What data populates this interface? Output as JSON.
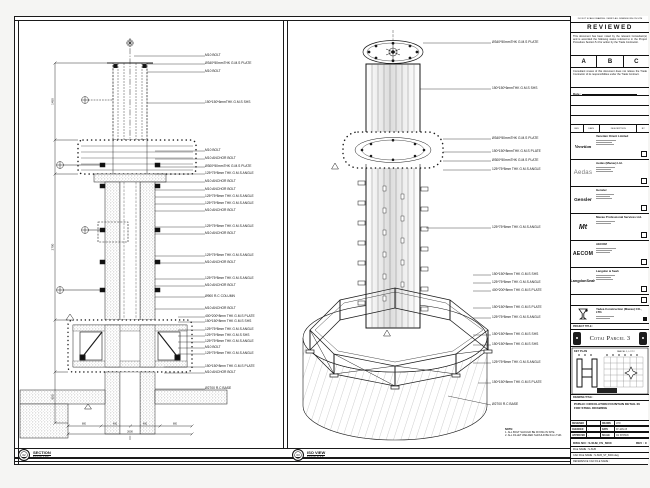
{
  "sheet": {
    "footer": {
      "section": {
        "bubble": "02",
        "title": "SECTION",
        "scale": "SCALE 1:50"
      },
      "iso": {
        "bubble": "03",
        "title": "ISO VIEW",
        "scale": "SCALE N.T.S"
      }
    },
    "notes": {
      "heading": "NOTE:",
      "line1": "1. ALL BOLT SHOULD BE FIXING IN SITE.",
      "line2": "2. ALL FILLET WELDED SHOULD BE 6mm THK."
    },
    "dims": {
      "h1": "1450",
      "h2": "2700",
      "h3": "800",
      "b1": "800",
      "b2": "400",
      "b3": "400",
      "b4": "800",
      "total": "2600"
    },
    "left_callouts": [
      {
        "t": "M10 BOLT"
      },
      {
        "t": "Ø340*50mmTHK G.M.S PLATE"
      },
      {
        "t": "M10 BOLT"
      },
      {
        "t": "150*150*6mmTHK G.M.S SHS"
      },
      {
        "t": "M10 BOLT"
      },
      {
        "t": "M10 ANCHOR BOLT"
      },
      {
        "t": "Ø300*50mmTHK G.M.S PLATE"
      },
      {
        "t": "125*75*8mm THK G.M.S ANGLE"
      },
      {
        "t": "M10 ANCHOR BOLT"
      },
      {
        "t": "M10 ANCHOR BOLT"
      },
      {
        "t": "125*75*8mm THK G.M.S ANGLE"
      },
      {
        "t": "125*75*8mm THK G.M.S ANGLE"
      },
      {
        "t": "M10 ANCHOR BOLT"
      },
      {
        "t": "125*75*8mm THK G.M.S ANGLE"
      },
      {
        "t": "M10 ANCHOR BOLT"
      },
      {
        "t": "125*75*8mm THK G.M.S ANGLE"
      },
      {
        "t": "M10 ANCHOR BOLT"
      },
      {
        "t": "125*75*8mm THK G.M.S ANGLE"
      },
      {
        "t": "M10 ANCHOR BOLT"
      },
      {
        "t": "Ø900 R.C COLUMN"
      },
      {
        "t": "M10 ANCHOR BOLT"
      },
      {
        "t": "400*200*8mm THK G.M.S PLATE"
      },
      {
        "t": "150*150*8mm THK G.M.S SHS"
      },
      {
        "t": "125*75*8mm THK G.M.S ANGLE"
      },
      {
        "t": "125*75*8mm THK G.M.S SHS"
      },
      {
        "t": "125*75*8mm THK G.M.S ANGLE"
      },
      {
        "t": "M10 BOLT"
      },
      {
        "t": "125*75*8mm THK G.M.S ANGLE"
      },
      {
        "t": "150*150*8mm THK G.M.S PLATE"
      },
      {
        "t": "M10 ANCHOR BOLT"
      },
      {
        "t": "Ø2700 R.C BASE"
      }
    ],
    "iso_callouts": [
      {
        "t": "Ø340*50mmTHK G.M.S PLATE"
      },
      {
        "t": "150*150*6mmTHK G.M.S SHS"
      },
      {
        "t": "Ø340*50mmTHK G.M.S PLATE"
      },
      {
        "t": "150*150*8mmTHK G.M.S PLATE"
      },
      {
        "t": "Ø300*50mmTHK G.M.S PLATE"
      },
      {
        "t": "125*75*8mm THK G.M.S ANGLE"
      },
      {
        "t": "125*75*8mm THK G.M.S ANGLE"
      },
      {
        "t": "150*150*8mm THK G.M.S SHS"
      },
      {
        "t": "125*75*8mm THK G.M.S ANGLE"
      },
      {
        "t": "400*200*8mm THK G.M.S PLATE"
      },
      {
        "t": "150*150*8mm THK G.M.S PLATE"
      },
      {
        "t": "125*75*8mm THK G.M.S ANGLE"
      },
      {
        "t": "150*150*8mm THK G.M.S SHS"
      },
      {
        "t": "150*150*8mm THK G.M.S SHS"
      },
      {
        "t": "125*75*8mm THK G.M.S ANGLE"
      },
      {
        "t": "150*150*8mm THK G.M.S PLATE"
      },
      {
        "t": "Ø2700 R.C BASE"
      }
    ]
  },
  "title_block": {
    "top_note": "DO NOT SCALE DRAWING. VERIFY ALL DIMENSIONS ON SITE",
    "reviewed": {
      "title": "REVIEWED",
      "p1": "This document has been noted by the relevant Consultant(s) and is accorded the following status referred to in the Project Procedure Section 5.4 for action by the Trade Contractor.",
      "options": [
        "A",
        "B",
        "C"
      ],
      "p2": "Consultant review of this document does not relieve the Trade Contractor of its responsibilities under the Trade Contract.",
      "date_label": "Date :"
    },
    "rev_table": {
      "h1": "REV",
      "h2": "DATE",
      "h3": "DESCRIPTION",
      "h4": "BY"
    },
    "companies": [
      {
        "logo": "Venetian",
        "name": "Venetian Orient Limited"
      },
      {
        "logo": "Aedas",
        "name": "Aedas (Macau) Ltd."
      },
      {
        "logo": "Gensler",
        "name": "Gensler"
      },
      {
        "logo": "Mt",
        "name": "Macau Professional Services Ltd."
      },
      {
        "logo": "AECOM",
        "name": "AECOM"
      },
      {
        "logo": "LangdonSeah",
        "name": "Langdon & Seah"
      }
    ],
    "contractor": {
      "name": "Yadea Construction (Macau) CO., LTD."
    },
    "project_title_label": "PROJECT TITLE :",
    "project_title": "Cotai Parcel 3",
    "key_plan": {
      "label": "KEY PLAN",
      "parcel": "PARCEL 1, LOT 2"
    },
    "drawing_title_label": "DRAWING TITLE :",
    "drawing_title": "PUBLIC CIRCULATION FOUNTAIN DETAIL IN FOR STEEL DRAWING",
    "fields": {
      "designed_label": "DESIGNED",
      "designed": "",
      "drawn_label": "DRAWN",
      "drawn": "LHO",
      "checked_label": "CHECKED",
      "checked": "-",
      "date_label": "DATE",
      "date": "07-JAN-15",
      "approved_label": "APPROVED",
      "approved": "-",
      "scale_label": "SCALE",
      "scale": "AS SHOWN"
    },
    "dwg_no_label": "DWG NO : S-SUB_FS_6000",
    "rev_label": "REV : C",
    "file_name": "FILE NAME : S-SUB",
    "cad_name": "CAD FILE NAME : S-SUB_ST_6000.dwg",
    "ref_name": "REFERENCE CAD FILE NAME :"
  }
}
